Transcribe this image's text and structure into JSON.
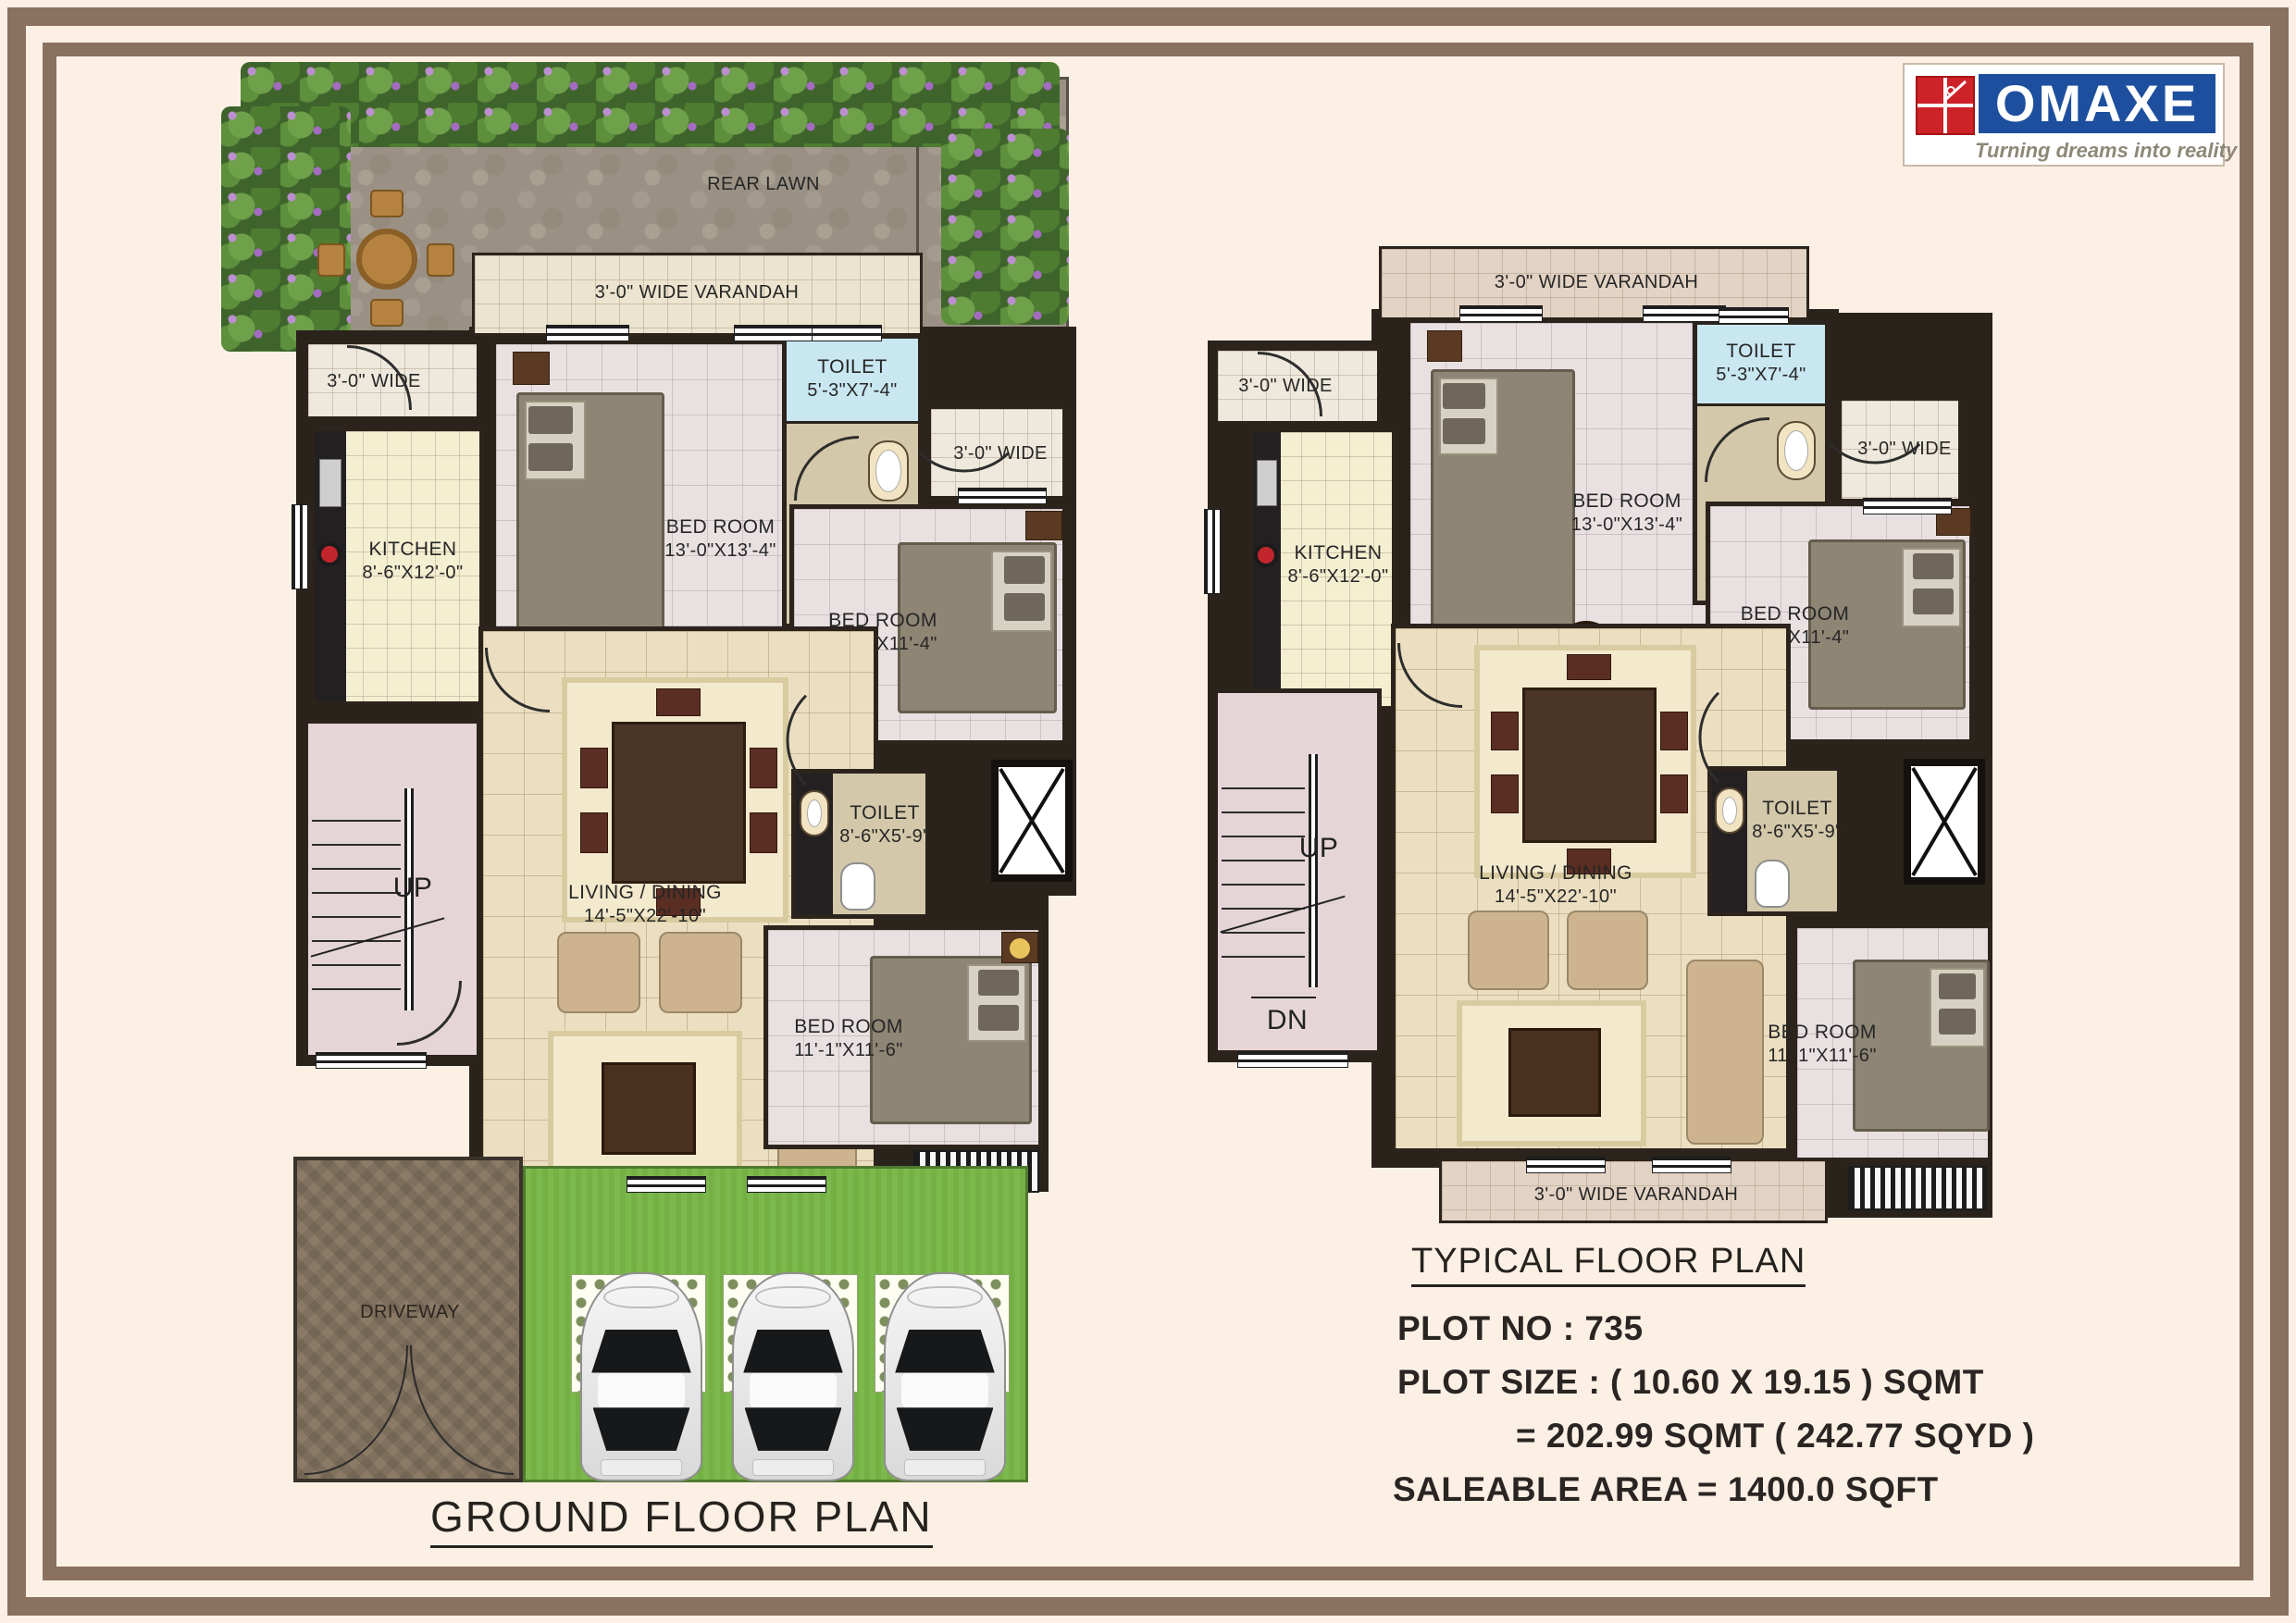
{
  "colors": {
    "background": "#fcf0e5",
    "frame_brown": "#8a7160",
    "wall_dark": "#2a231c",
    "lawn_green": "#7cb94c",
    "logo_blue": "#1d4f9e",
    "logo_red": "#cd2227"
  },
  "logo": {
    "name": "OMAXE",
    "tagline": "Turning dreams into reality"
  },
  "ground_plan": {
    "title": "GROUND FLOOR PLAN",
    "rear_lawn": "REAR LAWN",
    "varandah_top": "3'-0\" WIDE VARANDAH",
    "varandah_bottom": "3'-0\" WIDE VARANDAH",
    "passage_left": "3'-0\" WIDE",
    "passage_right": "3'-0\" WIDE",
    "driveway": "DRIVEWAY",
    "stairs_up": "UP",
    "rooms": {
      "kitchen": {
        "name": "KITCHEN",
        "dim": "8'-6\"X12'-0\""
      },
      "bedroom1": {
        "name": "BED ROOM",
        "dim": "13'-0\"X13'-4\""
      },
      "toilet1": {
        "name": "TOILET",
        "dim": "5'-3\"X7'-4\""
      },
      "bedroom2": {
        "name": "BED ROOM",
        "dim": "11'-6\"X11'-4\""
      },
      "living": {
        "name": "LIVING / DINING",
        "dim": "14'-5\"X22'-10\""
      },
      "toilet2": {
        "name": "TOILET",
        "dim": "8'-6\"X5'-9\""
      },
      "bedroom3": {
        "name": "BED ROOM",
        "dim": "11'-1\"X11'-6\""
      }
    }
  },
  "typical_plan": {
    "title": "TYPICAL FLOOR PLAN",
    "varandah_top": "3'-0\" WIDE VARANDAH",
    "varandah_bottom": "3'-0\" WIDE VARANDAH",
    "passage_left": "3'-0\" WIDE",
    "passage_right": "3'-0\" WIDE",
    "stairs_up": "UP",
    "stairs_dn": "DN",
    "rooms": {
      "kitchen": {
        "name": "KITCHEN",
        "dim": "8'-6\"X12'-0\""
      },
      "bedroom1": {
        "name": "BED ROOM",
        "dim": "13'-0\"X13'-4\""
      },
      "toilet1": {
        "name": "TOILET",
        "dim": "5'-3\"X7'-4\""
      },
      "bedroom2": {
        "name": "BED ROOM",
        "dim": "11'-6\"X11'-4\""
      },
      "living": {
        "name": "LIVING / DINING",
        "dim": "14'-5\"X22'-10\""
      },
      "toilet2": {
        "name": "TOILET",
        "dim": "8'-6\"X5'-9\""
      },
      "bedroom3": {
        "name": "BED ROOM",
        "dim": "11'-1\"X11'-6\""
      }
    }
  },
  "info": {
    "plot_no": "PLOT NO : 735",
    "plot_size": "PLOT SIZE : ( 10.60 X 19.15 ) SQMT",
    "plot_size2": "= 202.99 SQMT ( 242.77 SQYD )",
    "saleable": "SALEABLE AREA = 1400.0 SQFT"
  }
}
